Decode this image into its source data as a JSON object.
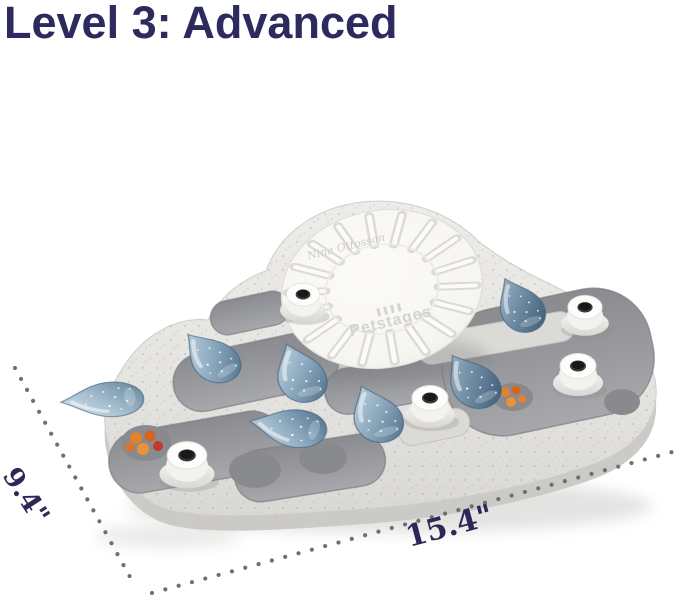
{
  "header": {
    "title": "Level 3: Advanced"
  },
  "product": {
    "kind": "cloud-shaped dog puzzle feeder with raindrop sliders, spinning dial, knob covers and treats",
    "dial_text_top": "Nina Ottosson",
    "dial_text_bottom": "Petstages",
    "raindrop_count": 7,
    "knob_count": 5,
    "treat_spot_count": 2
  },
  "dimensions": {
    "width_label": "15.4\"",
    "depth_label": "9.4\""
  },
  "colors": {
    "title_navy": "#2d2a5e",
    "board_gray": "#e6e5e2",
    "recess_gray": "#97989b",
    "raindrop_blue": "#7e9bb3",
    "treat_orange": "#e07a2c",
    "dimension_dot_gray": "#6f6f6f"
  }
}
